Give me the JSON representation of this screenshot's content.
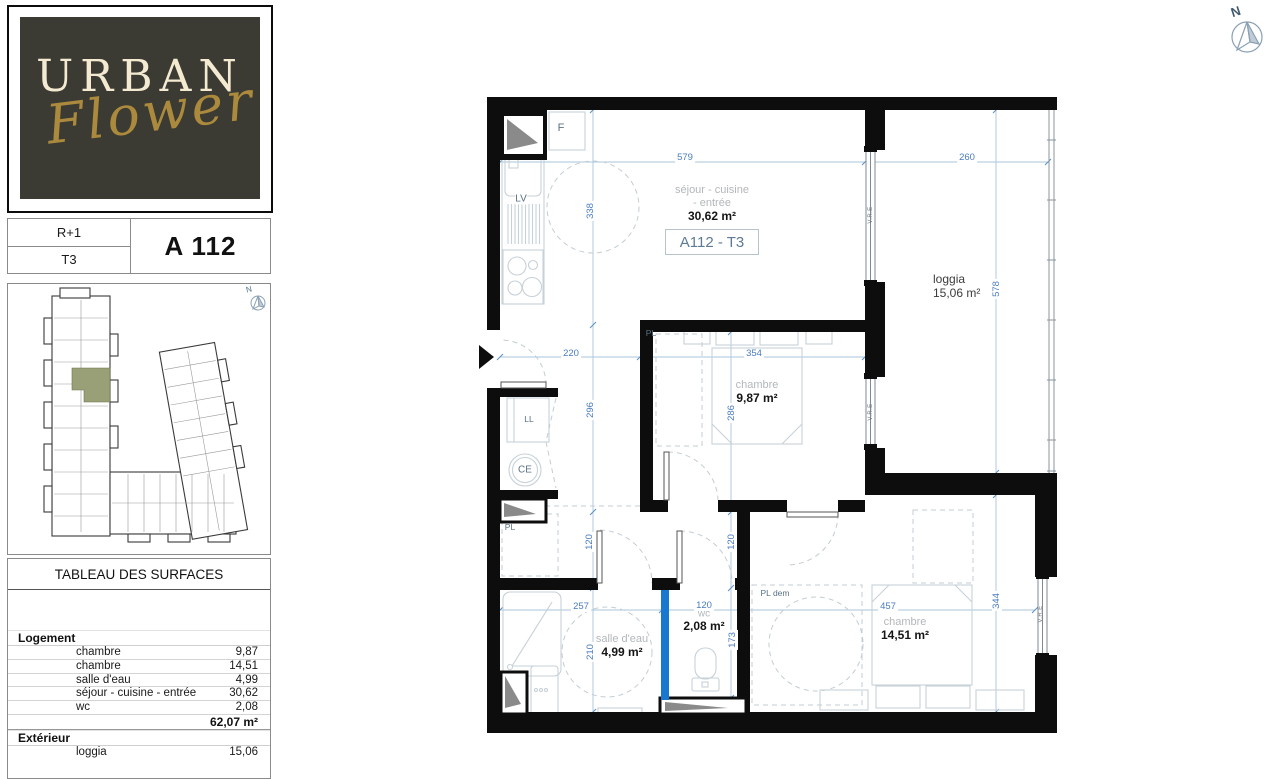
{
  "header": {
    "compass_label": "N"
  },
  "logo": {
    "line1": "URBAN",
    "line2": "Flower"
  },
  "unit_card": {
    "floor": "R+1",
    "type": "T3",
    "code": "A 112"
  },
  "site_plan": {
    "compass_label": "N"
  },
  "surface_table": {
    "title": "TABLEAU DES SURFACES",
    "logement_label": "Logement",
    "exterieur_label": "Extérieur",
    "logement_rows": [
      {
        "label": "chambre",
        "value": "9,87"
      },
      {
        "label": "chambre",
        "value": "14,51"
      },
      {
        "label": "salle d'eau",
        "value": "4,99"
      },
      {
        "label": "séjour - cuisine - entrée",
        "value": "30,62"
      },
      {
        "label": "wc",
        "value": "2,08"
      }
    ],
    "logement_total": "62,07 m²",
    "exterieur_rows": [
      {
        "label": "loggia",
        "value": "15,06"
      }
    ]
  },
  "plan": {
    "unit_tag": "A112 - T3",
    "rooms": {
      "sejour_line1": "séjour - cuisine",
      "sejour_line2": "- entrée",
      "sejour_area": "30,62 m²",
      "chambre1_name": "chambre",
      "chambre1_area": "9,87 m²",
      "chambre2_name": "chambre",
      "chambre2_area": "14,51 m²",
      "salle_deau_name": "salle d'eau",
      "salle_deau_area": "4,99 m²",
      "wc_name": "wc",
      "wc_area": "2,08 m²",
      "loggia_name": "loggia",
      "loggia_area": "15,06 m²"
    },
    "equipment": {
      "fridge": "F",
      "dishwasher": "LV",
      "washing_machine": "LL",
      "water_heater": "CE",
      "closet": "PL",
      "closet_hall": "PL",
      "closet_dem": "PL dem",
      "window_shutter": "V.R.E"
    },
    "dims": {
      "sejour_w": "579",
      "sejour_h": "338",
      "loggia_w": "260",
      "loggia_h": "578",
      "entree_w": "220",
      "entree_h": "296",
      "chambre1_w": "354",
      "chambre1_h": "286",
      "hall_left": "120",
      "hall_right": "120",
      "salle_deau_w": "257",
      "salle_deau_h": "210",
      "wc_w": "120",
      "wc_h": "173",
      "chambre2_w": "457",
      "chambre2_h": "344"
    }
  }
}
